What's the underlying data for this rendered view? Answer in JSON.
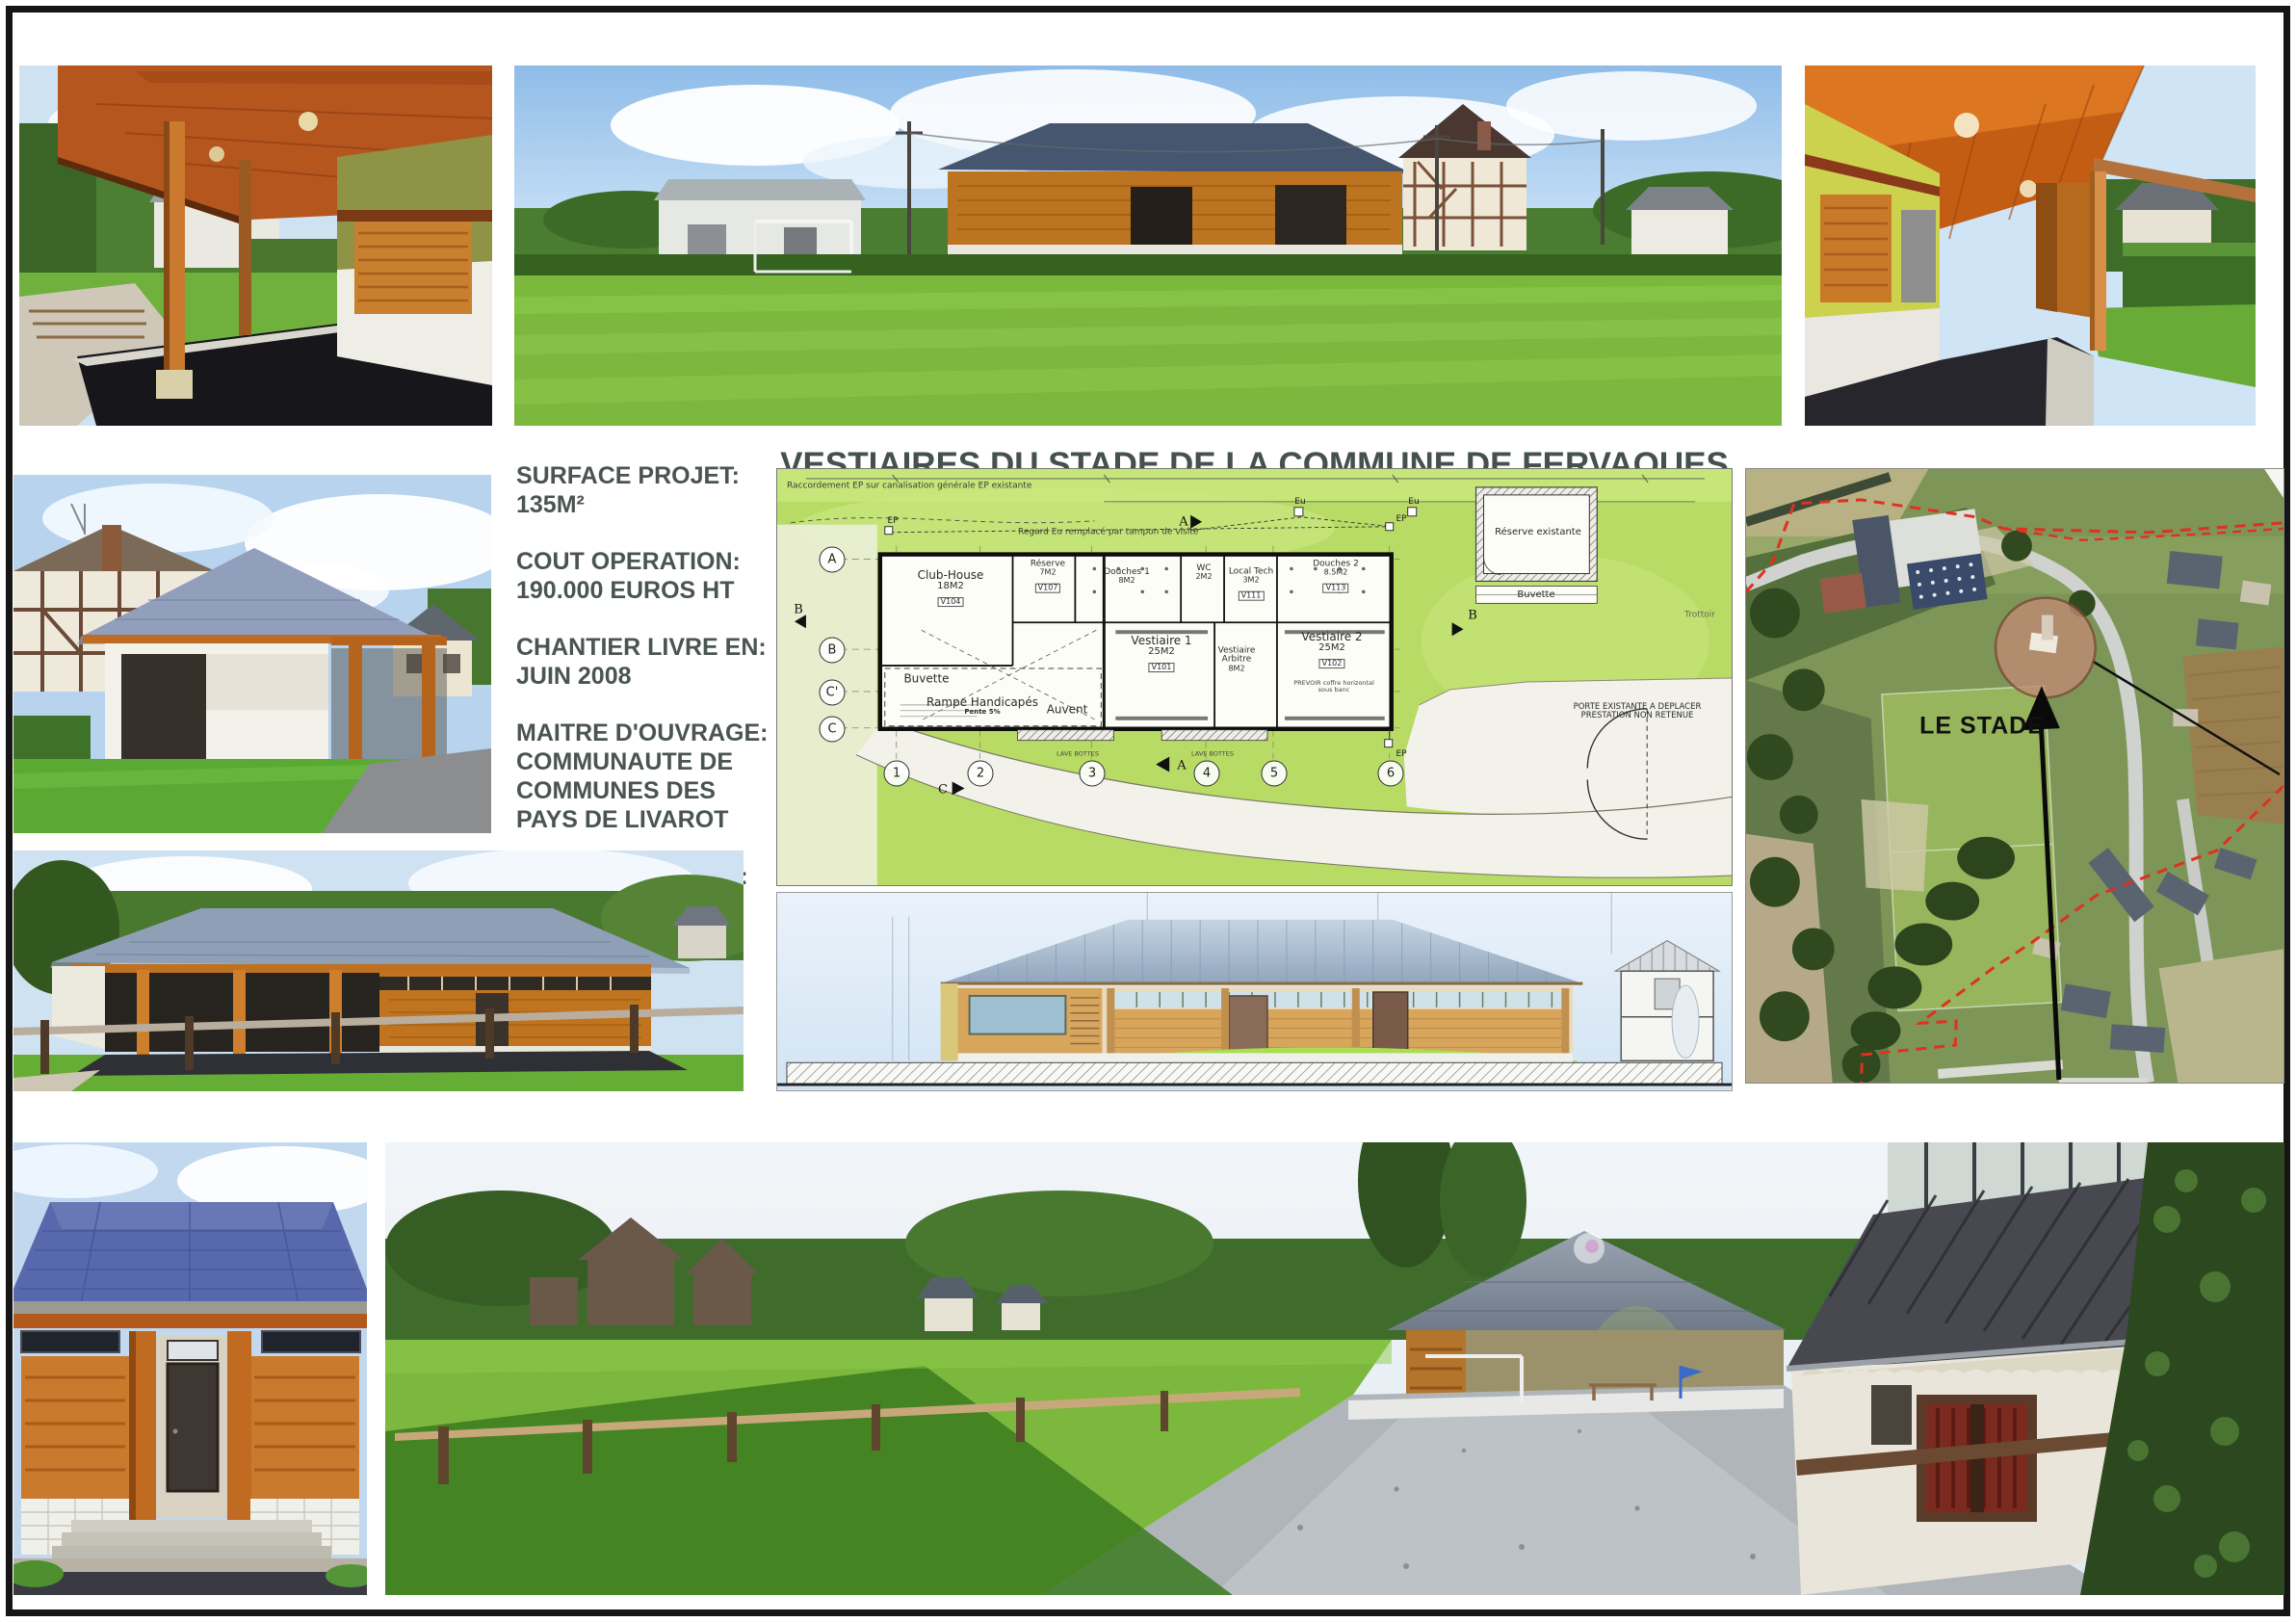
{
  "board": {
    "title": "VESTIAIRES DU STADE  DE LA COMMUNE DE FERVAQUES"
  },
  "info": {
    "items": [
      {
        "label": "SURFACE PROJET:",
        "value": "135M²"
      },
      {
        "label": "COUT OPERATION:",
        "value": "190.000 EUROS HT"
      },
      {
        "label": "CHANTIER LIVRE EN:",
        "value": "JUIN 2008"
      },
      {
        "label": "MAITRE D'OUVRAGE:",
        "value": "COMMUNAUTE DE COMMUNES DES PAYS DE LIVAROT"
      },
      {
        "label": "MAITRE D'OEUVRE:",
        "value": "PERRET FELIX ARCHITECTE DPLG"
      }
    ]
  },
  "plan": {
    "rooms": [
      {
        "name": "Club-House",
        "area": "18M2",
        "tag": "V104"
      },
      {
        "name": "Réserve",
        "area": "7M2",
        "tag": "V107"
      },
      {
        "name": "Douches 1",
        "area": "8M2",
        "tag": ""
      },
      {
        "name": "WC",
        "area": "2M2",
        "tag": ""
      },
      {
        "name": "Local Tech",
        "area": "3M2",
        "tag": "V111"
      },
      {
        "name": "Douches 2",
        "area": "8.5M2",
        "tag": "V113"
      },
      {
        "name": "Vestiaire 1",
        "area": "25M2",
        "tag": "V101"
      },
      {
        "name": "Vestiaire Arbitre",
        "area": "8M2",
        "tag": ""
      },
      {
        "name": "Vestiaire 2",
        "area": "25M2",
        "tag": "V102"
      },
      {
        "name": "Buvette"
      },
      {
        "name": "Rampe Handicapés",
        "sub": "Pente 5%"
      },
      {
        "name": "Auvent"
      },
      {
        "name": "Réserve existante"
      },
      {
        "name": "Buvette"
      }
    ],
    "notes": {
      "raccordement": "Raccordement EP  sur canalisation générale EP existante",
      "regard": "Regard Eu remplacé par tampon de visite",
      "trottoir": "Trottoir",
      "porte1": "PORTE EXISTANTE A DEPLACER",
      "porte2": "PRESTATION NON RETENUE",
      "prevoir": "PREVOIR coffre horizontal sous banc",
      "lave": "LAVE BOTTES"
    },
    "markers": {
      "ep": "EP",
      "eu": "Eu",
      "sa": "A",
      "sb": "B",
      "sc": "C"
    },
    "grid_rows": [
      "A",
      "B",
      "C'",
      "C"
    ],
    "grid_cols": [
      "1",
      "2",
      "3",
      "4",
      "5",
      "6"
    ]
  },
  "map": {
    "label": "LE STADE"
  },
  "colors": {
    "title_text": "#44514d",
    "wood_accent": "#c9762a",
    "roof_slate": "#5868ac",
    "plan_grass": "#b8db65",
    "map_highlight": "#b5846f",
    "boundary_red": "#e03020"
  }
}
